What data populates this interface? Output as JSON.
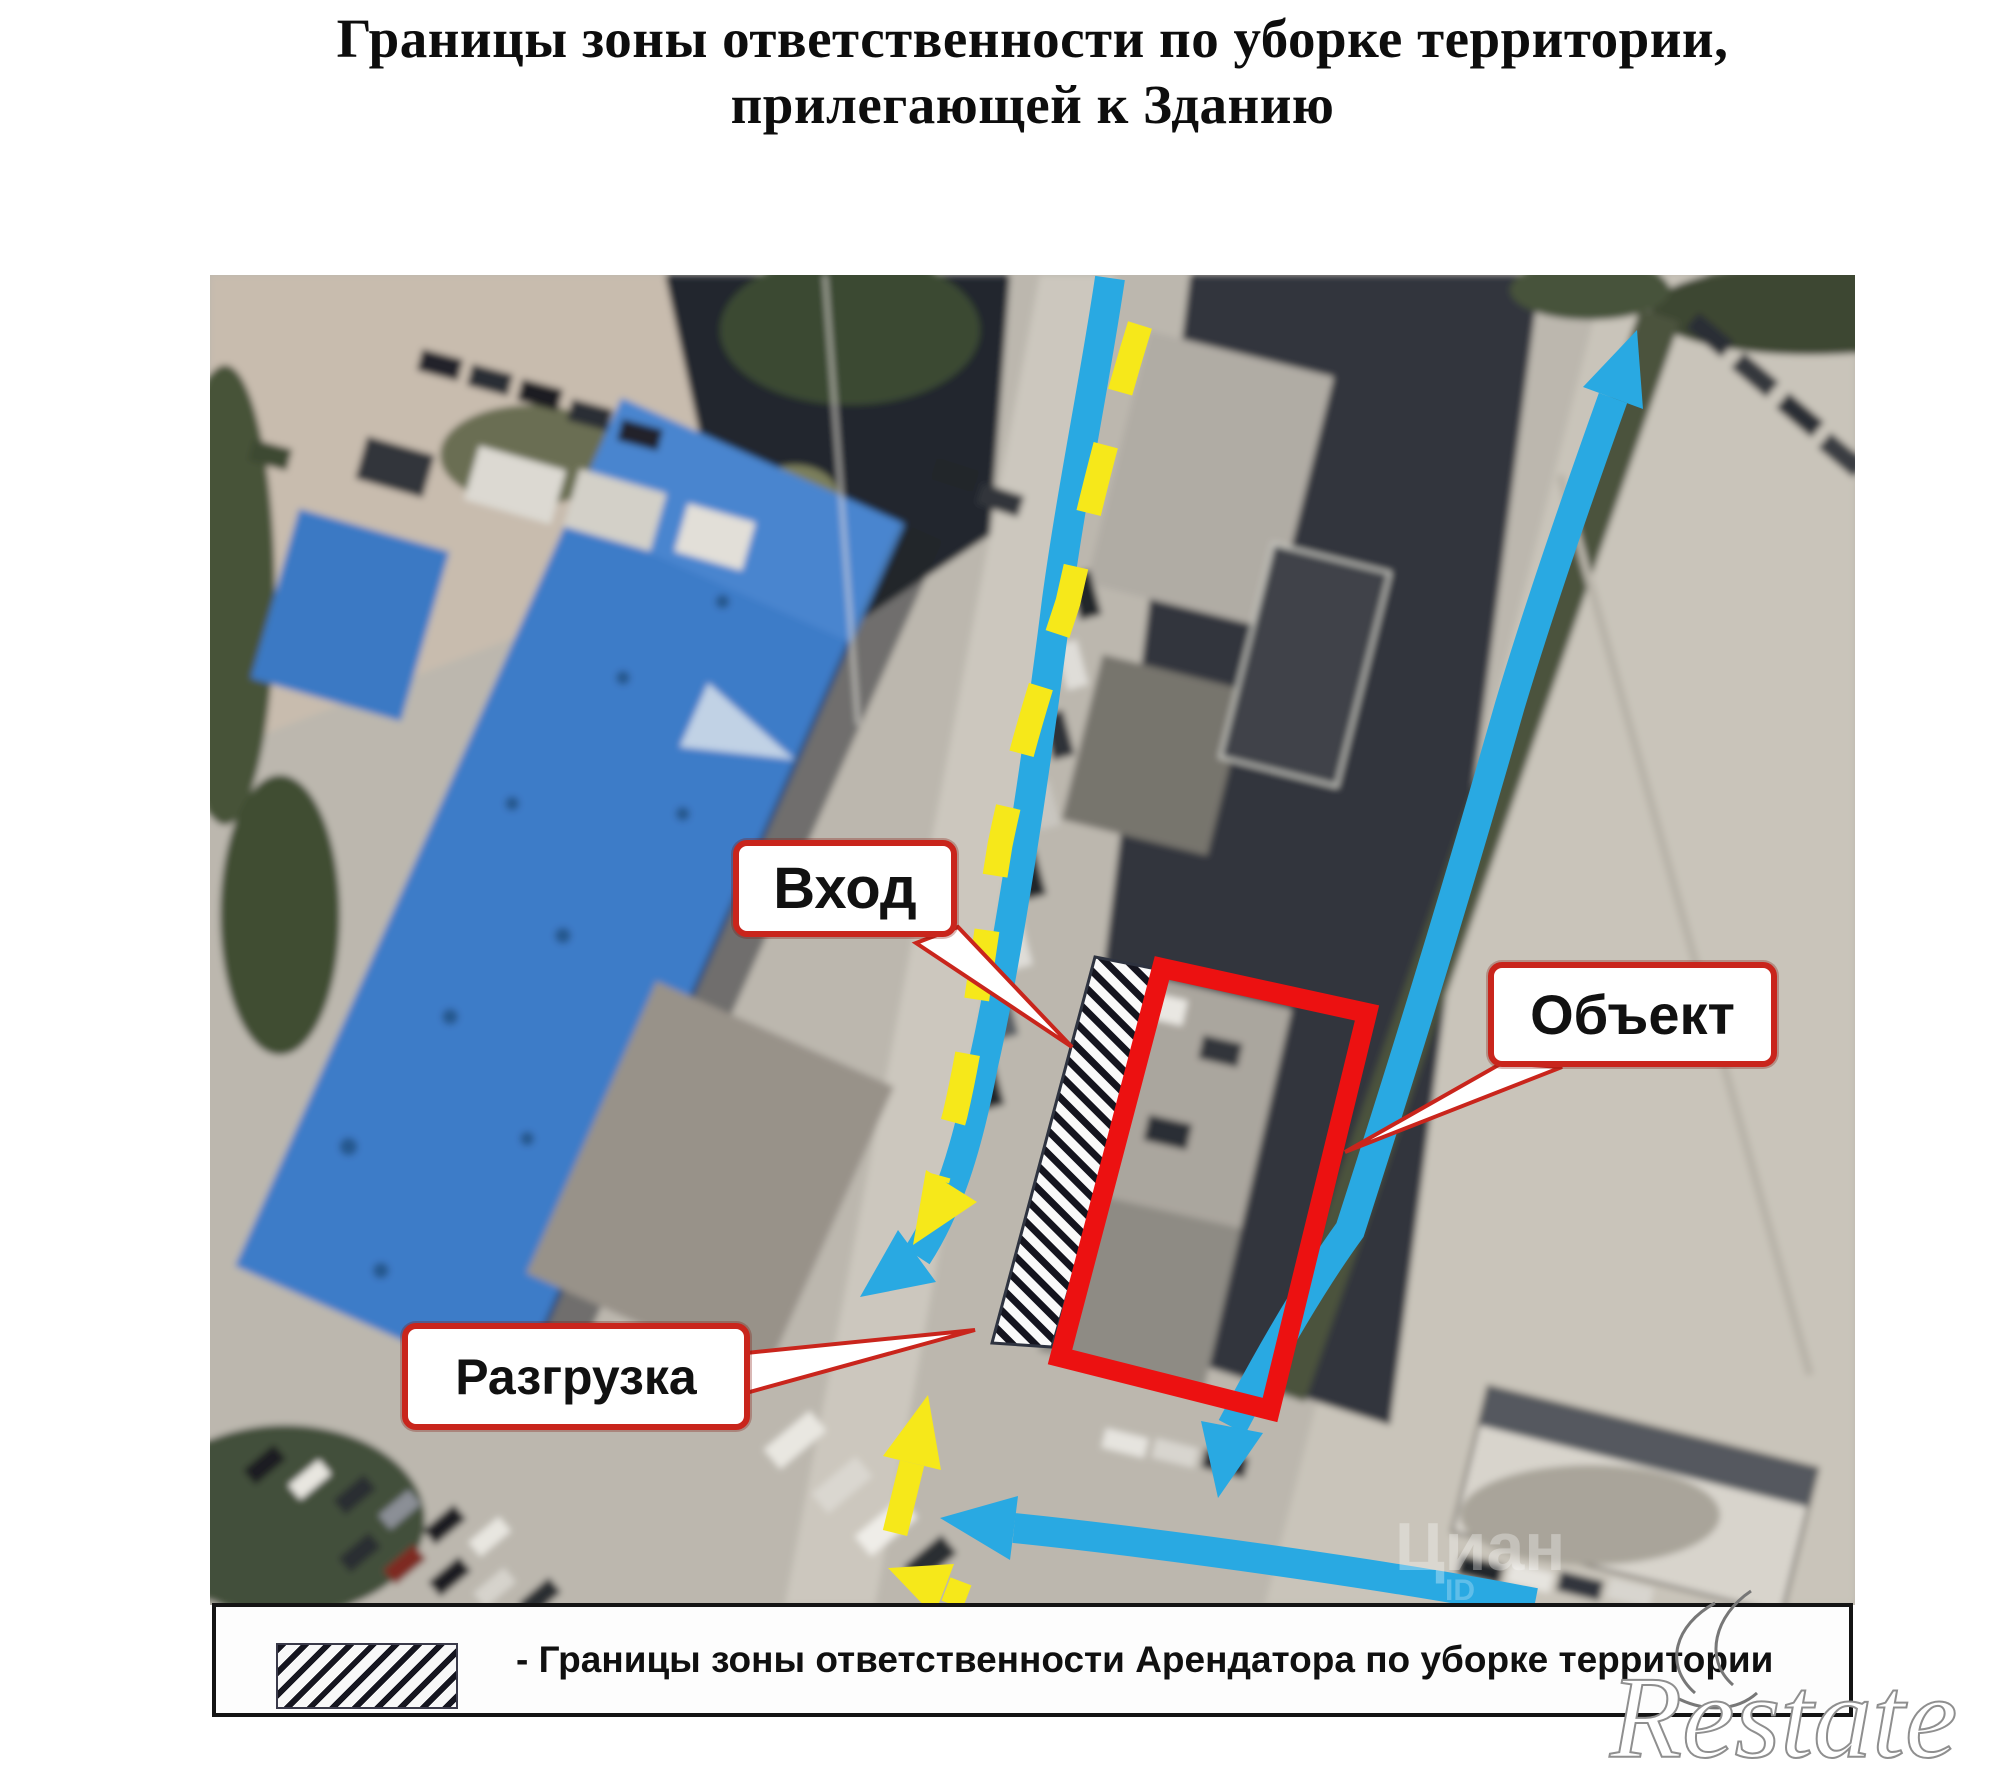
{
  "title": {
    "line1": "Границы зоны ответственности по уборке территории,",
    "line2": "прилегающей к Зданию"
  },
  "map": {
    "callouts": {
      "entrance": "Вход",
      "object": "Объект",
      "unloading": "Разгрузка"
    },
    "watermarks": {
      "map_brand": "Циан",
      "map_id_label": "ID",
      "page_brand": "Restate"
    }
  },
  "legend": {
    "text": "- Границы зоны ответственности Арендатора по уборке территории"
  },
  "colors": {
    "route_blue": "#29a9e2",
    "route_yellow": "#f6e81a",
    "object_red": "#ec1111",
    "callout_border": "#c9251c",
    "hatch_dark": "#14141e"
  }
}
